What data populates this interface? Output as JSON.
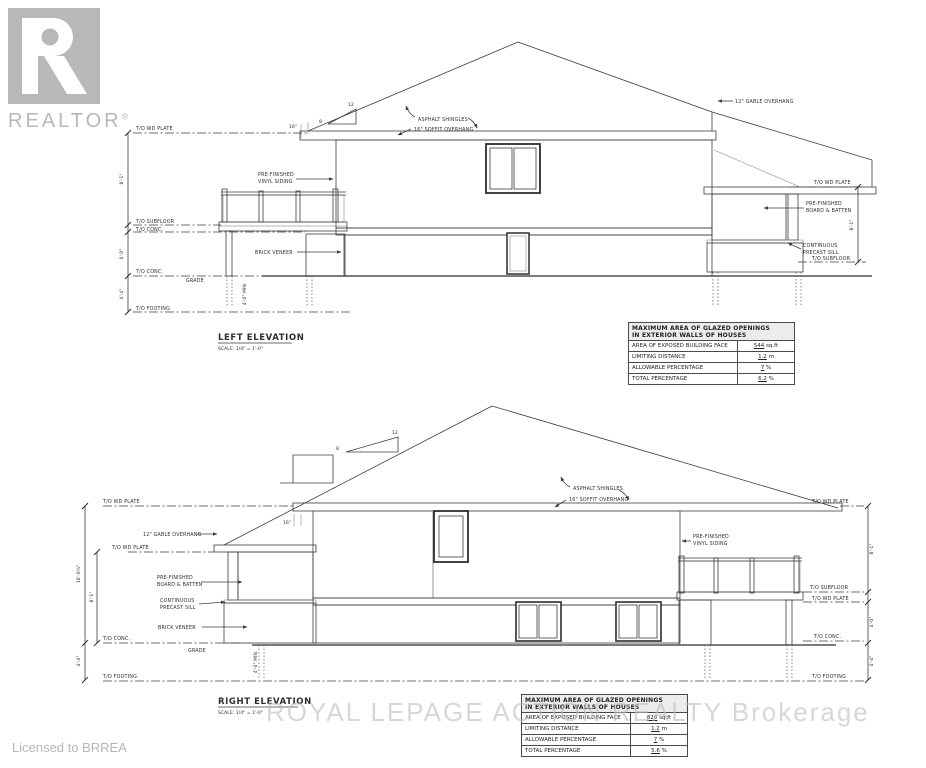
{
  "branding": {
    "logo_text": "REALTOR",
    "logo_reg": "®",
    "license_text": "Licensed to BRREA",
    "watermark": "ROYAL LEPAGE ACTION REALTY Brokerage"
  },
  "labels": {
    "to_wd_plate": "T/O WD PLATE",
    "to_subfloor": "T/O SUBFLOOR",
    "to_conc": "T/O CONC.",
    "to_footing": "T/O FOOTING",
    "grade": "GRADE",
    "asphalt_shingles": "ASPHALT SHINGLES",
    "soffit_overhang": "16\" SOFFIT OVERHANG",
    "gable_overhang": "12\" GABLE OVERHANG",
    "prefinished": "PRE-FINISHED",
    "vinyl_siding": "VINYL SIDING",
    "board_batten": "BOARD & BATTEN",
    "continuous": "CONTINUOUS",
    "precast_sill": "PRECAST SILL",
    "brick_veneer": "BRICK VENEER",
    "slope_run": "12",
    "slope_rise": "8",
    "soffit_tick": "16\""
  },
  "dimensions": {
    "storey": "8'-1\"",
    "basement": "6'-0\"",
    "footing_depth": "4'-4\"",
    "lower_storey": "4'-0\"",
    "overall": "16'-0¾\"",
    "frost_min": "4'-0\" MIN."
  },
  "left_elevation": {
    "title": "LEFT ELEVATION",
    "scale": "SCALE: 1/4\" = 1'-0\""
  },
  "right_elevation": {
    "title": "RIGHT ELEVATION",
    "scale": "SCALE: 1/4\" = 1'-0\""
  },
  "glazing_table_left": {
    "title1": "MAXIMUM AREA OF GLAZED OPENINGS",
    "title2": "IN EXTERIOR WALLS OF HOUSES",
    "rows": [
      {
        "label": "AREA OF EXPOSED BUILDING FACE",
        "value": "544",
        "unit": "sq.ft"
      },
      {
        "label": "LIMITING DISTANCE",
        "value": "1.2",
        "unit": "m"
      },
      {
        "label": "ALLOWABLE PERCENTAGE",
        "value": "7",
        "unit": "%"
      },
      {
        "label": "TOTAL PERCENTAGE",
        "value": "6.2",
        "unit": "%"
      }
    ]
  },
  "glazing_table_right": {
    "title1": "MAXIMUM AREA OF GLAZED OPENINGS",
    "title2": "IN EXTERIOR WALLS OF HOUSES",
    "rows": [
      {
        "label": "AREA OF EXPOSED BUILDING FACE",
        "value": "820",
        "unit": "sq.ft"
      },
      {
        "label": "LIMITING DISTANCE",
        "value": "1.2",
        "unit": "m"
      },
      {
        "label": "ALLOWABLE PERCENTAGE",
        "value": "7",
        "unit": "%"
      },
      {
        "label": "TOTAL PERCENTAGE",
        "value": "5.6",
        "unit": "%"
      }
    ]
  },
  "colors": {
    "line": "#3d3d3d",
    "watermark_gray": "#bdbdbd",
    "logo_gray": "#b8b8b8"
  }
}
